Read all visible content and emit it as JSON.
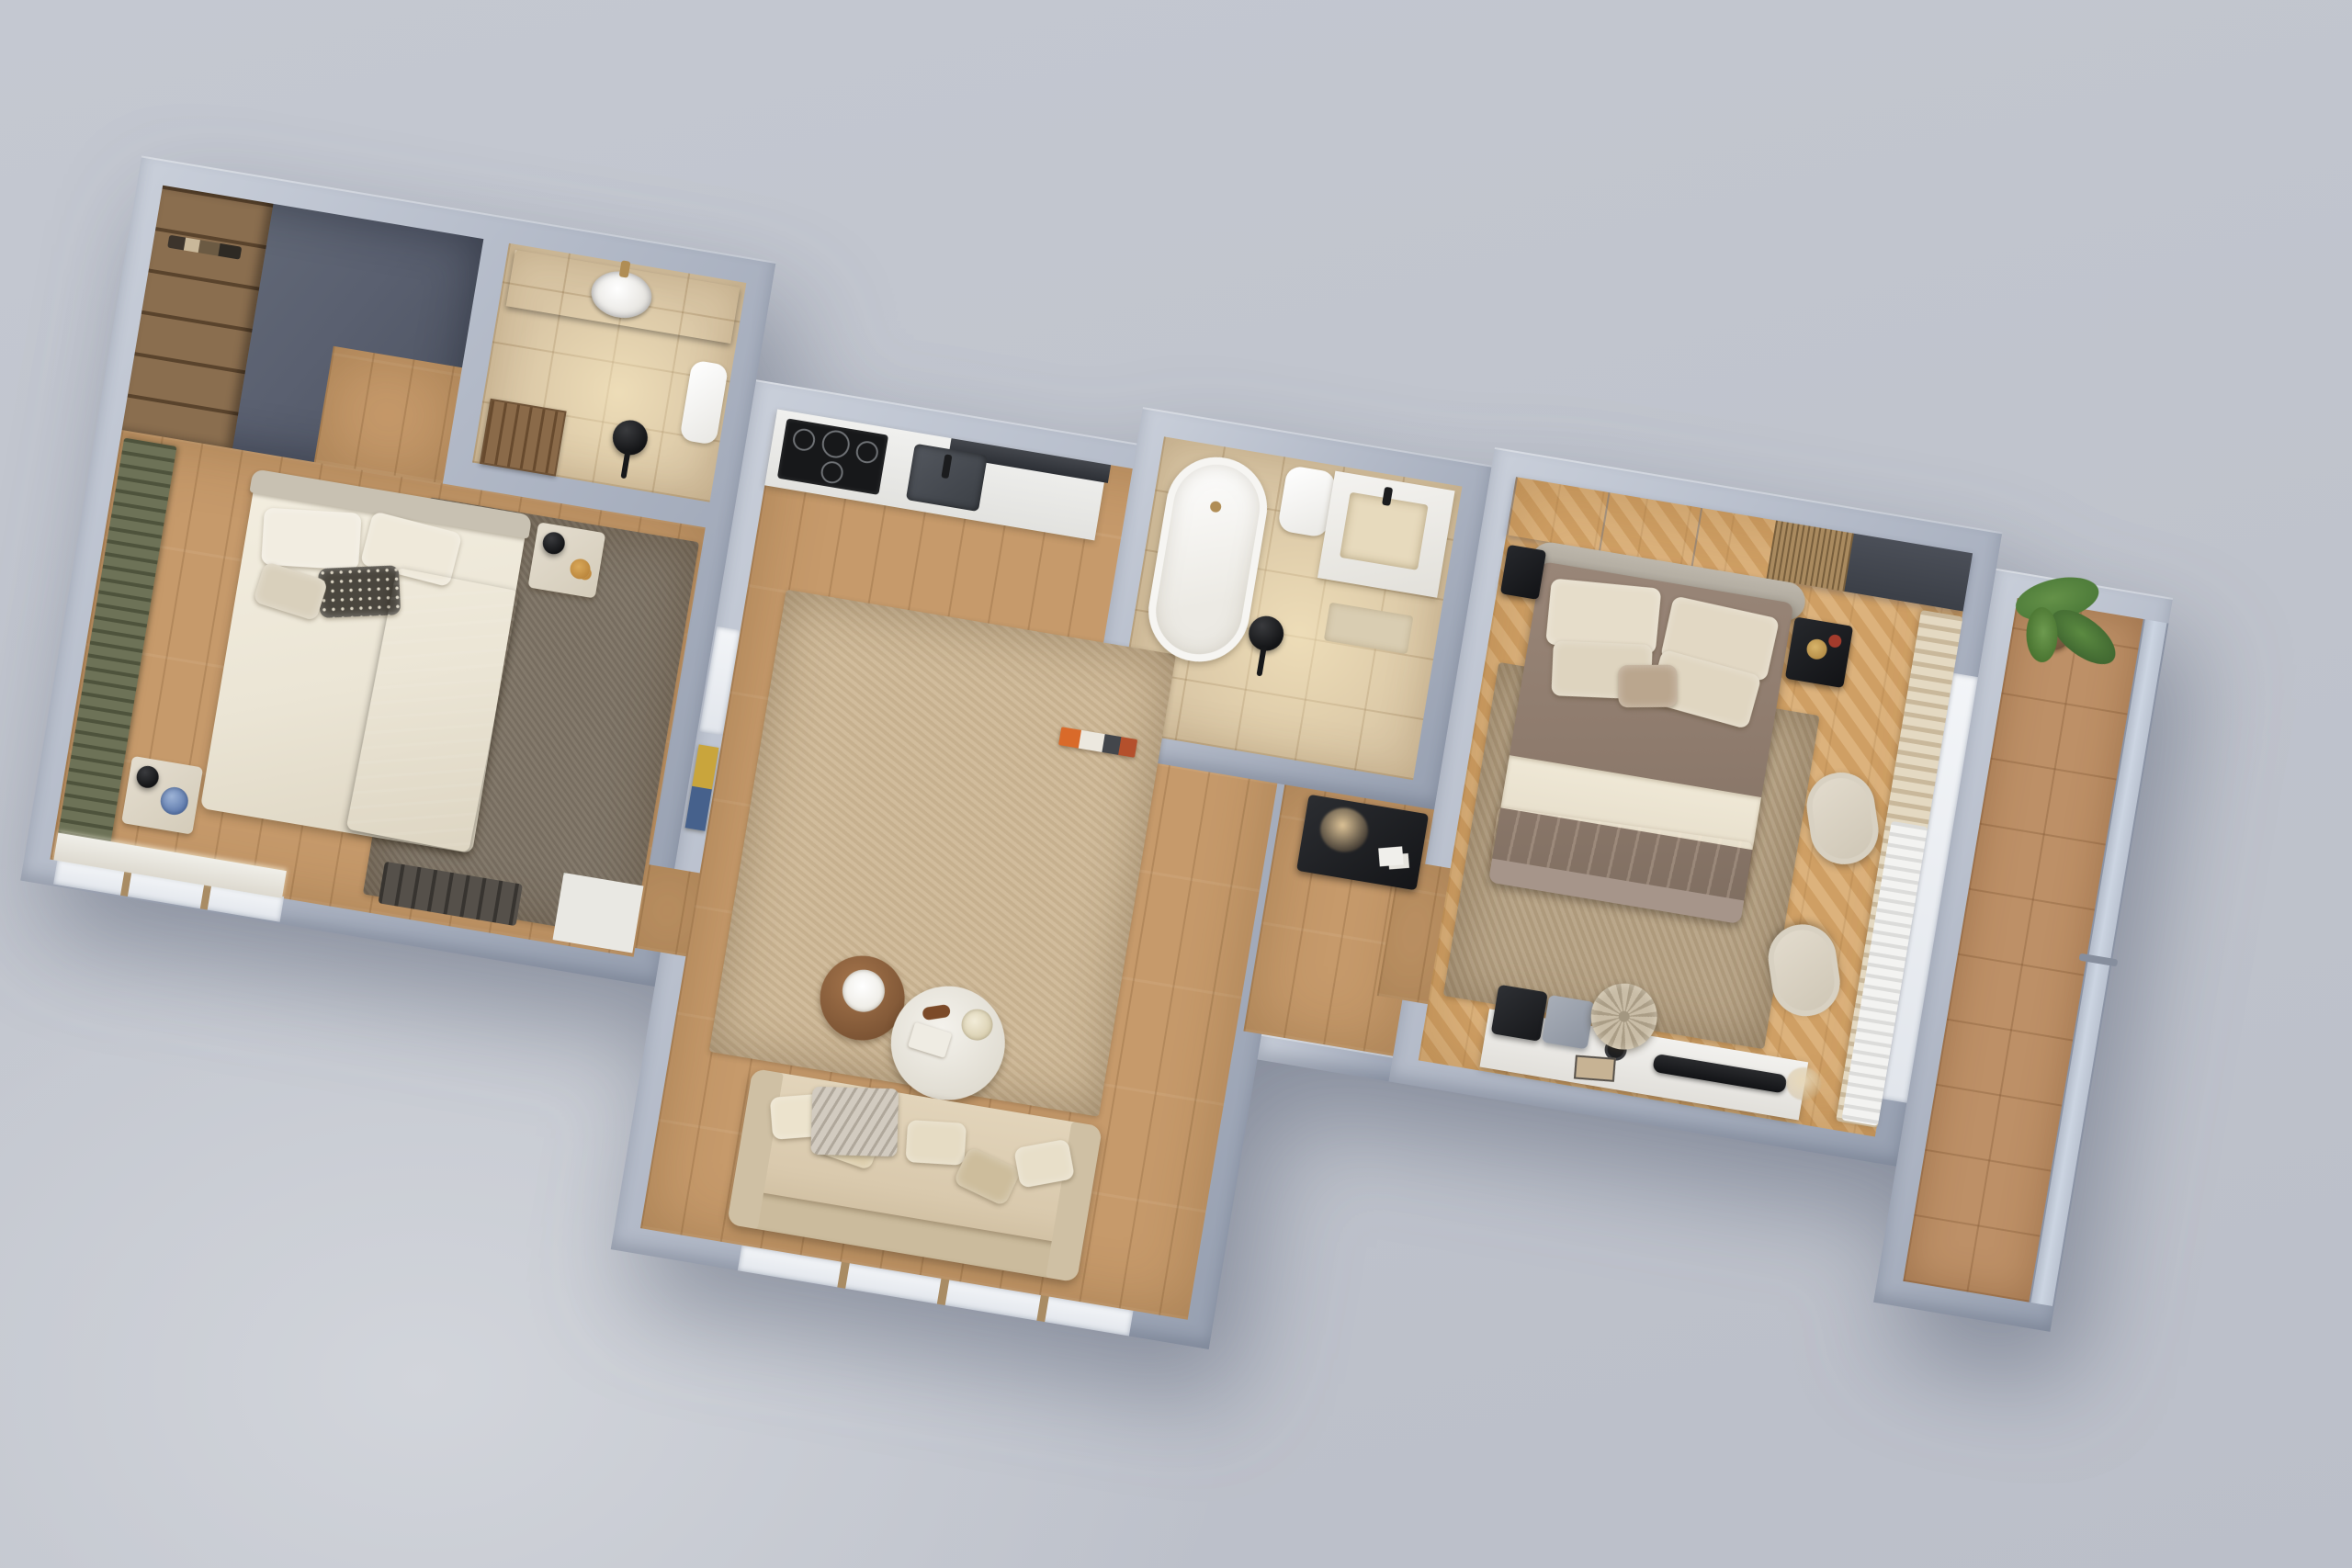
{
  "scene": {
    "kind": "3d-floorplan-render",
    "view": "top-down axonometric",
    "plan_rotation_deg": 9.5,
    "style": "photoreal interior render, no visible text"
  },
  "palette": {
    "bg": "#bfc3cc",
    "bglight": "#d2d5db",
    "wallface": "#97a0b1",
    "walltop": "#c9cfda",
    "oak": "#c69a6b",
    "chevA": "#dcb27c",
    "chevB": "#cf9f64",
    "tile": "#d8c5a4",
    "slate": "#5a6070",
    "wardrobe": "#8a6e4f",
    "marble": "#413f42",
    "white": "#f1f1f0",
    "rugbeige": "#cdb795",
    "rugbrown": "#7d7365",
    "rugtaupe": "#b5a183",
    "sofa": "#d9c9ad",
    "linen": "#ebe5d5",
    "darkthrow": "#46413b",
    "duvet": "#8d7a6c",
    "sheet": "#e8e0cd",
    "terracotta": "#b06f4a",
    "curtgreen": "#6d7257",
    "curtcream": "#e4d9c2",
    "ink": "#1f2022",
    "balctile": "#bd9067",
    "plant": "#4e7c3a",
    "glass": "#ccd5e2"
  },
  "rooms": [
    {
      "id": "entry",
      "label": "Entry hall",
      "floor": "dark slate",
      "furniture": [
        "wood wardrobe shelving"
      ]
    },
    {
      "id": "bathroom-1",
      "label": "Bathroom 1",
      "floor": "beige stone tile",
      "furniture": [
        "dark marble vanity",
        "round white basin",
        "wall cabinet",
        "wood slat door",
        "black floor lamp"
      ]
    },
    {
      "id": "bedroom-1",
      "label": "Bedroom",
      "floor": "oak plank",
      "furniture": [
        "green ribbed curtain",
        "double bed with white linen",
        "dark fringed throw",
        "patterned pillow",
        "nightstand with lamp and amber flowers",
        "nightstand with blue hydrangea",
        "brown rug",
        "dark doormat",
        "marble threshold",
        "window sill"
      ]
    },
    {
      "id": "kitchen-living",
      "label": "Kitchen / Living room",
      "floor": "oak plank",
      "furniture": [
        "white counter",
        "gas hob",
        "dark sink",
        "range hood",
        "wall art",
        "small window",
        "beige area rug",
        "round wood side table with tray",
        "round white coffee table",
        "beige sofa with cushions and throw",
        "panorama window"
      ]
    },
    {
      "id": "bathroom-2",
      "label": "Bathroom 2",
      "floor": "beige stone tile",
      "furniture": [
        "freestanding oval bathtub",
        "wall-hung toilet",
        "vanity with basin",
        "black floor lamp",
        "bath mat"
      ]
    },
    {
      "id": "hallway",
      "label": "Hallway",
      "floor": "oak plank",
      "furniture": [
        "black console with pampas grass and photos",
        "book spines on ledge"
      ]
    },
    {
      "id": "bedroom-2",
      "label": "Master bedroom",
      "floor": "chevron parquet",
      "furniture": [
        "sliding wardrobe",
        "rattan bench section",
        "double bed with taupe duvet and terracotta throw",
        "curved headboard",
        "two black nightstands",
        "area rug",
        "two cream lounge chairs",
        "cream and sheer curtains",
        "white vanity desk",
        "black chair",
        "gray chair",
        "TV soundbar",
        "round tufted pouf",
        "dried flowers"
      ]
    },
    {
      "id": "balcony",
      "label": "Balcony",
      "floor": "terracotta tile",
      "furniture": [
        "potted green plant",
        "glass railing"
      ]
    }
  ]
}
